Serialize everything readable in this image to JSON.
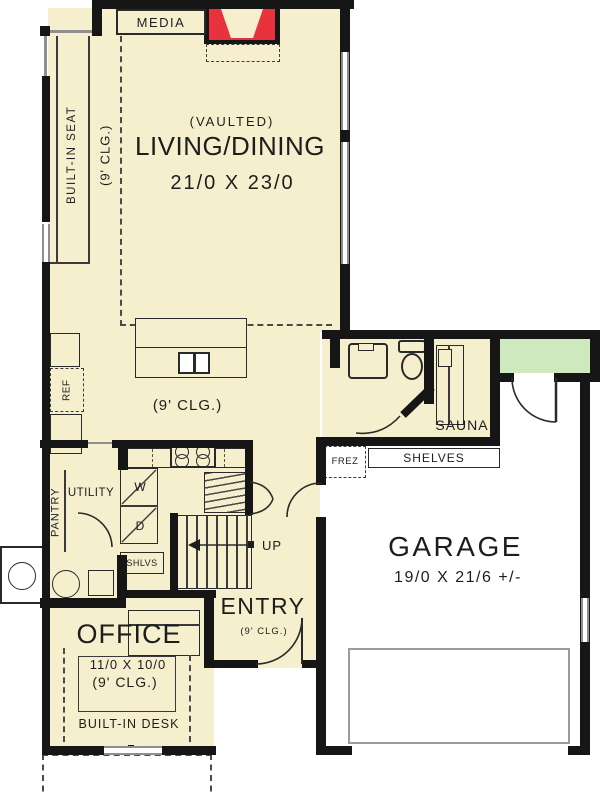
{
  "plan": {
    "colors": {
      "floor": "#f6efcd",
      "wall": "#161616",
      "window": "#8f8f8f",
      "porch": "#cfe9bf",
      "fireplace": "#e8333e",
      "line": "#2a2a2a",
      "ink": "#1d1d1d"
    },
    "media": {
      "label": "MEDIA"
    },
    "seat": {
      "label": "BUILT-IN SEAT",
      "ceiling": "(9' CLG.)"
    },
    "living": {
      "note": "(VAULTED)",
      "name": "LIVING/DINING",
      "dims": "21/0 X 23/0"
    },
    "kitchen": {
      "ceiling": "(9' CLG.)",
      "fridge": "REF"
    },
    "pantry": {
      "label": "PANTRY"
    },
    "utility": {
      "label": "UTILITY",
      "washer": "W",
      "dryer": "D",
      "shelves": "SHLVS"
    },
    "stairs": {
      "direction": "UP"
    },
    "entry": {
      "name": "ENTRY",
      "ceiling": "(9' CLG.)"
    },
    "office": {
      "name": "OFFICE",
      "dims": "11/0 X 10/0",
      "ceiling": "(9' CLG.)",
      "desk": "BUILT-IN DESK"
    },
    "sauna": {
      "label": "SAUNA"
    },
    "garage": {
      "name": "GARAGE",
      "dims": "19/0 X 21/6 +/-",
      "freezer": "FREZ",
      "shelves": "SHELVES"
    }
  }
}
